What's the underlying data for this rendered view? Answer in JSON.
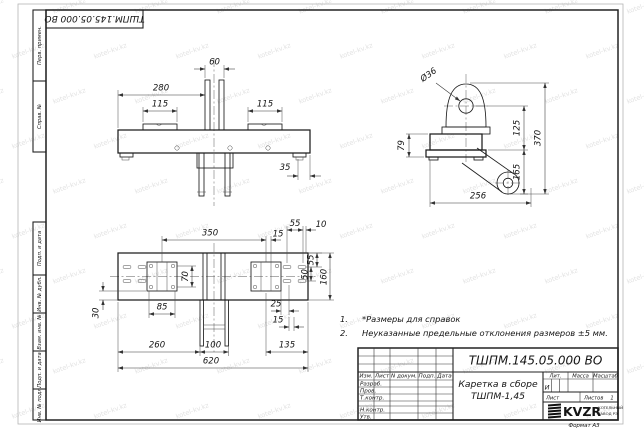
{
  "stamp": {
    "designation": "ТШПМ.145.05.000 ВО"
  },
  "margin": {
    "top": [
      "Перв. примен.",
      "Справ. №"
    ],
    "bottom": [
      "Подп. и дата",
      "Инв. № дубл.",
      "Взам. инв. №",
      "Подп. и дата",
      "Инв. № подл."
    ]
  },
  "dims": {
    "front": {
      "w280": "280",
      "w60": "60",
      "w115l": "115",
      "w115r": "115",
      "w35": "35"
    },
    "side": {
      "dia": "Ø36",
      "h79": "79",
      "h125": "125",
      "h370": "370",
      "h165": "165",
      "w256": "256"
    },
    "plan": {
      "w350": "350",
      "w15t": "15",
      "w55t": "55",
      "w10": "10",
      "h70": "70",
      "h55": "55",
      "h50": "50",
      "h160": "160",
      "w85": "85",
      "h30": "30",
      "w25": "25",
      "w15b": "15",
      "w260": "260",
      "w100": "100",
      "w135": "135",
      "w620": "620"
    }
  },
  "notes": {
    "n1_num": "1.",
    "n1": "*Размеры для справок",
    "n2_num": "2.",
    "n2": "Неуказанные предельные отклонения размеров  ±5 мм."
  },
  "title_block": {
    "designation": "ТШПМ.145.05.000 ВО",
    "name_line1": "Каретка в сборе",
    "name_line2": "ТШПМ-1,45",
    "header_cells": [
      "Изм.",
      "Лист",
      "N докум.",
      "Подп.",
      "Дата"
    ],
    "rows": [
      "Разраб.",
      "Пров.",
      "Т.контр.",
      "Н.контр.",
      "Утв."
    ],
    "lit_label": "Лит.",
    "mass_label": "Масса",
    "scale_label": "Масштаб",
    "lit_value": "И",
    "sheet_label": "Лист",
    "sheets_label": "Листов",
    "sheets_value": "1",
    "logo_text": "KVZR",
    "logo_sub1": "КОТЕЛЬНЫЙ",
    "logo_sub2": "ЗАВОД РЭ",
    "format_label": "Формат А3"
  },
  "watermark": {
    "text": "kotel-kv.kz"
  }
}
